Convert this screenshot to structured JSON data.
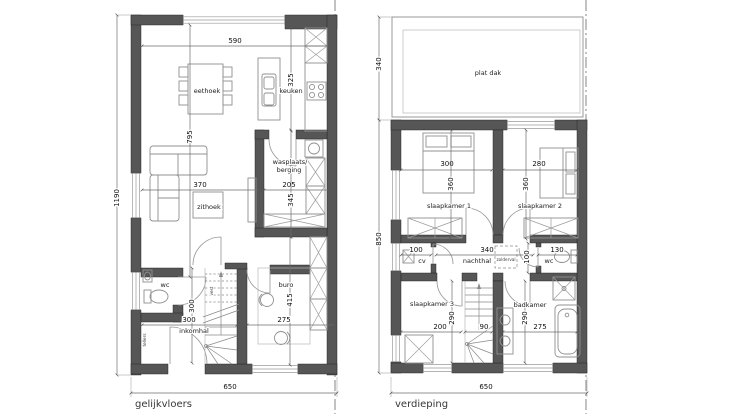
{
  "ground_floor": {
    "label": "gelijkvloers",
    "rooms": {
      "eethoek": "eethoek",
      "keuken": "keuken",
      "wasplaats_line1": "wasplaats/",
      "wasplaats_line2": "berging",
      "zithoek": "zithoek",
      "wc": "wc",
      "inkomhal": "inkomhal",
      "buro": "buro",
      "vest": "vest",
      "tellers": "tellers"
    },
    "dimensions": {
      "top_width": "590",
      "keuken_depth": "325",
      "living_depth": "795",
      "zithoek_width": "370",
      "wasplaats_width": "205",
      "wasplaats_depth": "345",
      "total_depth": "1190",
      "inkomhal_depth": "300",
      "inkomhal_width": "300",
      "buro_depth": "415",
      "buro_width": "275",
      "total_width": "650"
    }
  },
  "upper_floor": {
    "label": "verdieping",
    "rooms": {
      "plat_dak": "plat dak",
      "slaapkamer1": "slaapkamer 1",
      "slaapkamer2": "slaapkamer 2",
      "cv": "cv",
      "nachthal": "nachthal",
      "zolderval": "zolderval",
      "wc": "wc",
      "slaapkamer3": "slaapkamer 3",
      "badkamer": "badkamer"
    },
    "dimensions": {
      "plat_dak_depth": "340",
      "floor_depth": "850",
      "slaapkamer1_width": "300",
      "slaapkamer1_depth": "360",
      "slaapkamer2_width": "280",
      "slaapkamer2_depth": "360",
      "cv_width": "100",
      "nachthal_width": "340",
      "nachthal_depth": "100",
      "wc_width": "130",
      "slaapkamer3_width": "200",
      "slaapkamer3_depth": "290",
      "stairs_width": "90",
      "badkamer_depth": "290",
      "badkamer_width": "275",
      "total_width": "650"
    }
  },
  "colors": {
    "wall": "#565656",
    "line": "#8f8f8f",
    "dimension": "#6d6d6d",
    "text": "#101010",
    "background": "#ffffff"
  }
}
